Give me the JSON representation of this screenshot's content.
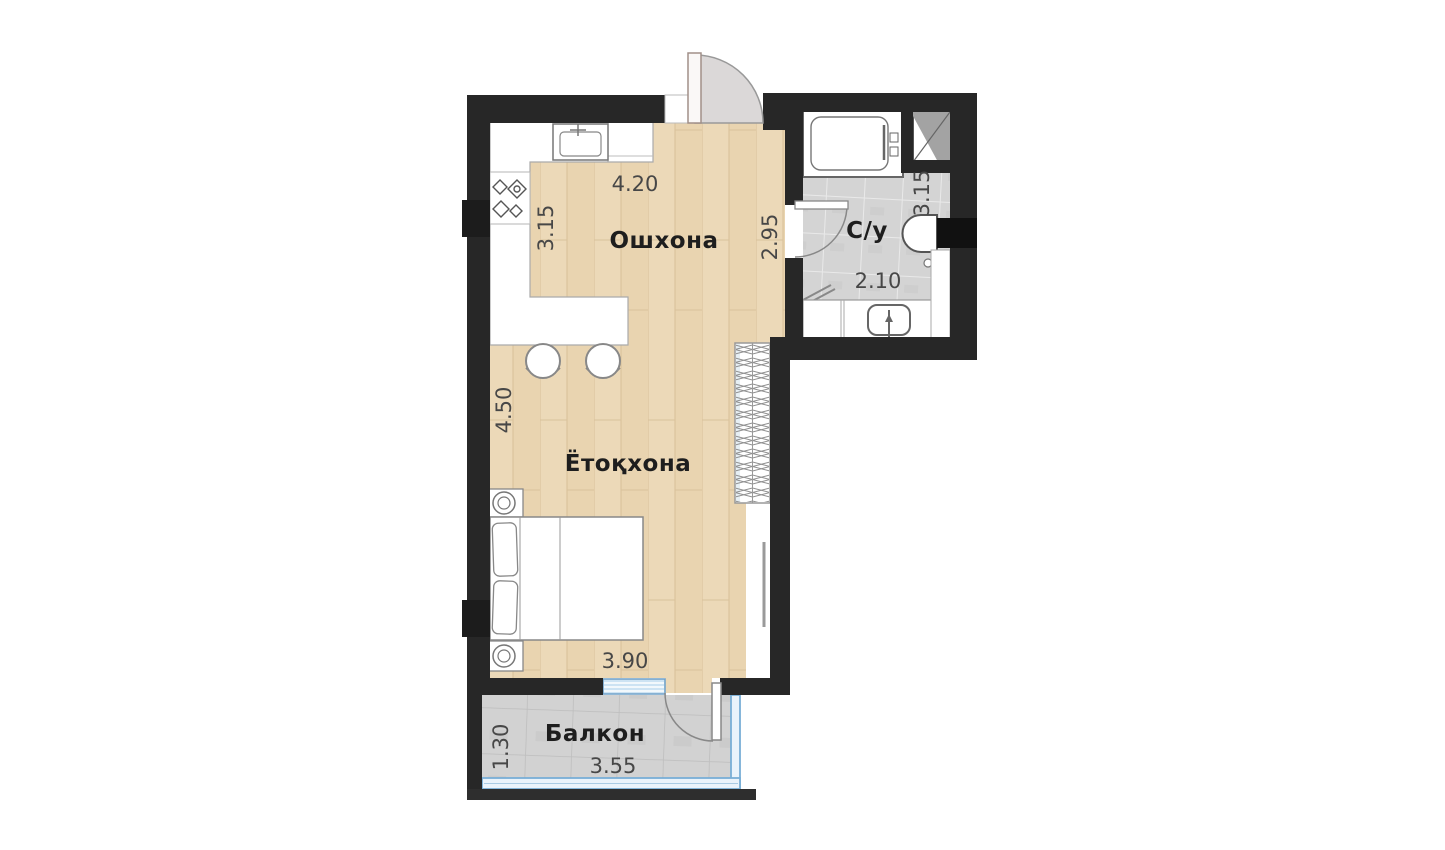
{
  "floor_plan": {
    "rooms": {
      "kitchen": {
        "label": "Ошхона",
        "dim_top": "4.20",
        "dim_left": "3.15",
        "dim_right": "2.95"
      },
      "bedroom": {
        "label": "Ётоқхона",
        "dim_left": "4.50",
        "dim_bottom": "3.90"
      },
      "bathroom": {
        "label": "С/у",
        "dim_right": "3.15",
        "dim_bottom": "2.10"
      },
      "balcony": {
        "label": "Балкон",
        "dim_left": "1.30",
        "dim_bottom": "3.55"
      }
    },
    "fixtures": [
      "kitchen-sink",
      "stove-burners",
      "counter",
      "bar-table",
      "stools",
      "bathtub",
      "vent-shaft",
      "toilet",
      "washbasin",
      "vanity",
      "bed",
      "pillows",
      "nightstands",
      "wardrobe",
      "radiator",
      "entrance-door",
      "bathroom-door",
      "balcony-door",
      "balcony-window"
    ],
    "colors": {
      "wall": "#272727",
      "wood_floor": "#ecd9b8",
      "bathroom_tile": "#d4d4d4",
      "balcony_tile": "#d2d2d2",
      "window_blue": "#cde3f3",
      "glazing_blue": "#79aed6",
      "door_swing_fill": "#dbd8d8",
      "furniture_outline": "#8a8a8a",
      "room_label_text": "#1e1e1e",
      "dimension_text": "#474747",
      "background": "#ffffff"
    }
  }
}
